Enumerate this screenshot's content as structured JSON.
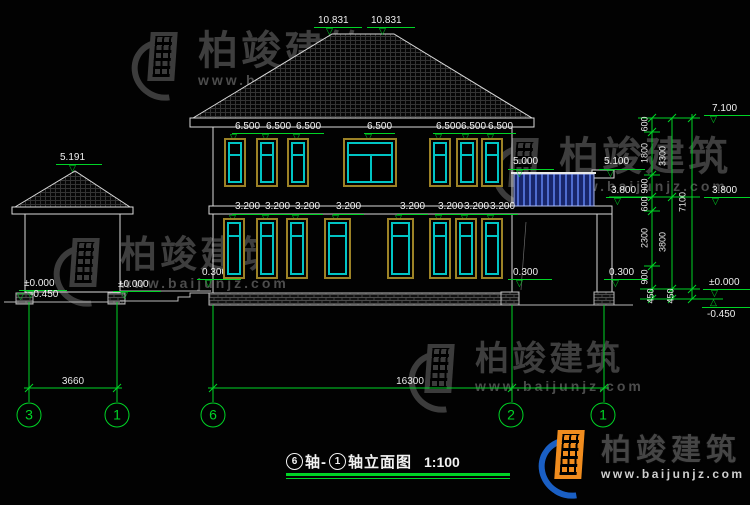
{
  "drawing": {
    "title": {
      "axis_start": "6",
      "axis_mid": "轴-",
      "axis_end": "1",
      "name": "轴立面图",
      "scale": "1:100"
    },
    "elevation_markers": [
      "10.831",
      "10.831",
      "7.100",
      "5.191",
      "5.000",
      "5.100",
      "3.800",
      "3.800",
      "0.300",
      "0.300",
      "0.300",
      "±0.000",
      "-0.450",
      "±0.000",
      "±0.000",
      "-0.450"
    ],
    "floor2_window_labels": [
      "6.500",
      "6.500",
      "6.500",
      "6.500",
      "6.500",
      "6.500",
      "6.500"
    ],
    "floor1_window_labels": [
      "3.200",
      "3.200",
      "3.200",
      "3.200",
      "3.200",
      "3.200",
      "3.200",
      "3.200"
    ],
    "dim_chain": {
      "col1": [
        "600",
        "1800",
        "900",
        "600",
        "2300",
        "900"
      ],
      "col2": [
        "3300",
        "3800"
      ],
      "col3": [
        "7100"
      ],
      "base": [
        "450",
        "450"
      ]
    },
    "bottom_dims": {
      "left": "3660",
      "right": "16300"
    },
    "axis_bubbles": [
      "3",
      "1",
      "6",
      "2",
      "1"
    ]
  },
  "watermark": {
    "name": "柏竣建筑",
    "url": "www.baijunjz.com"
  }
}
